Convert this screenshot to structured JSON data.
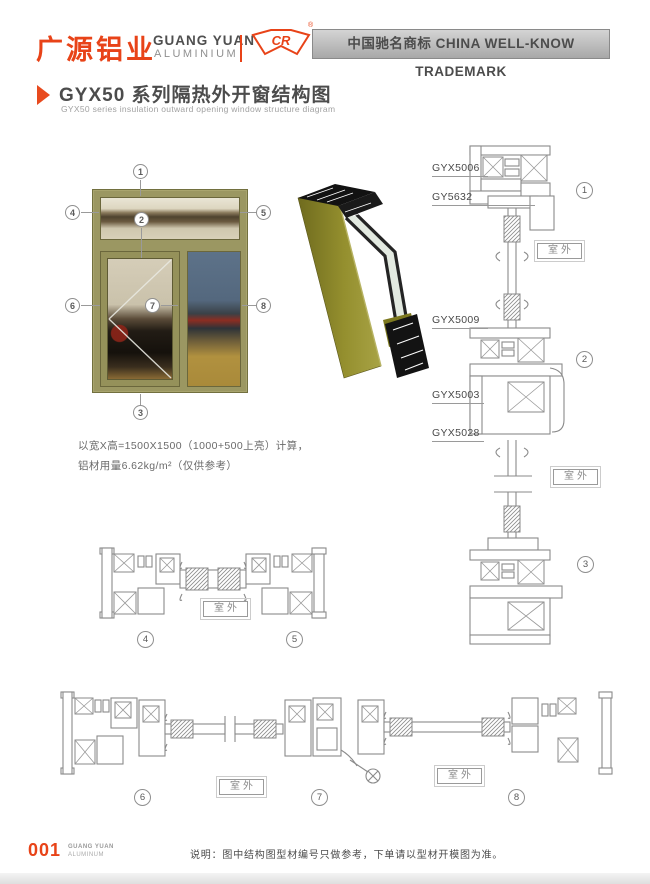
{
  "header": {
    "logo_cn": "广源铝业",
    "logo_en1": "GUANG YUAN",
    "logo_en2": "ALUMINIUM",
    "logo_mark": "CR",
    "registered": "®",
    "banner": "中国驰名商标 CHINA WELL-KNOW TRADEMARK"
  },
  "title": {
    "main": "GYX50 系列隔热外开窗结构图",
    "sub": "GYX50 series insulation outward opening window structure diagram"
  },
  "spec": {
    "line1": "以宽X高=1500X1500（1000+500上亮）计算，",
    "line2": "铝材用量6.62kg/m²（仅供参考）"
  },
  "labels": {
    "outdoor": "室外"
  },
  "profiles": {
    "p5006": "GYX5006",
    "p5632": "GY5632",
    "p5009": "GYX5009",
    "p5003": "GYX5003",
    "p5028": "GYX5028"
  },
  "numbers": {
    "n1": "1",
    "n2": "2",
    "n3": "3",
    "n4": "4",
    "n5": "5",
    "n6": "6",
    "n7": "7",
    "n8": "8"
  },
  "footer": {
    "page": "001",
    "brand1": "GUANG YUAN",
    "brand2": "ALUMINUM",
    "note": "说明：图中结构图型材编号只做参考，下单请以型材开模图为准。"
  }
}
